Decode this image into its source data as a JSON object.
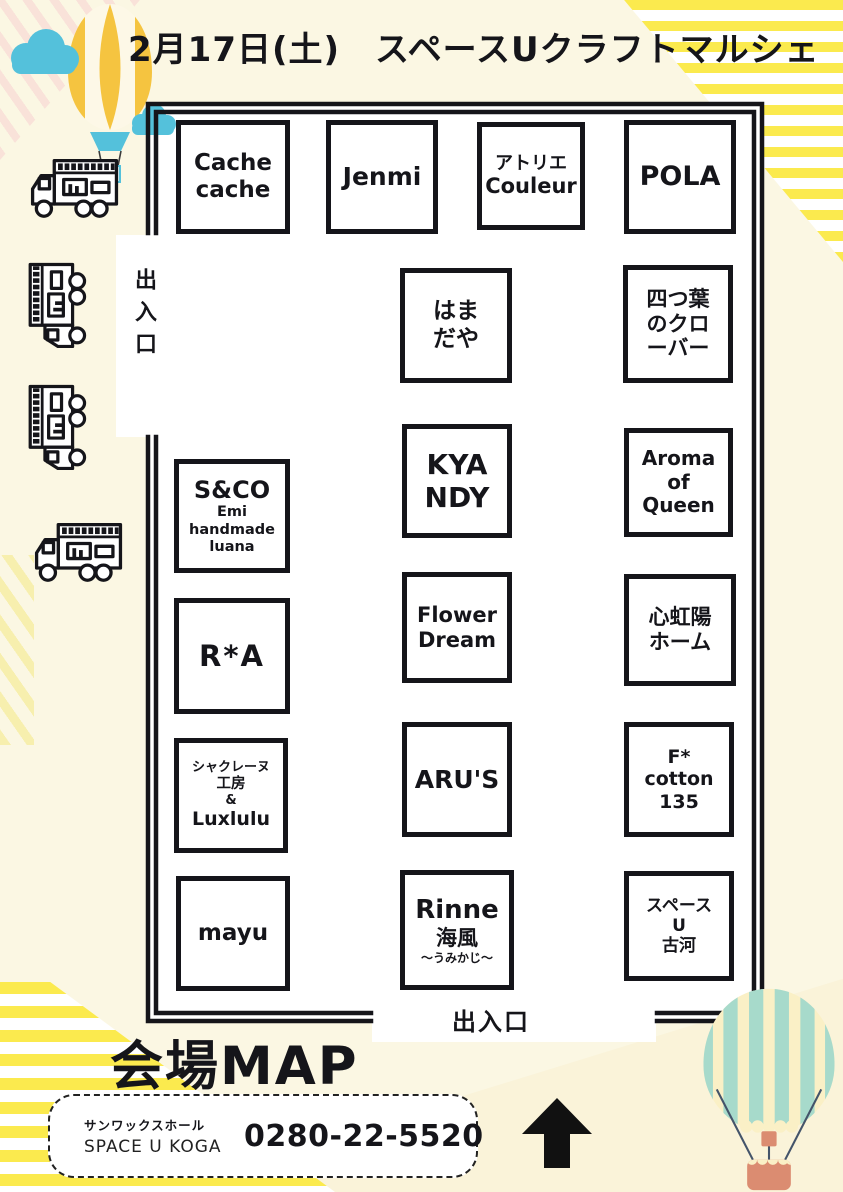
{
  "page": {
    "title": "2月17日(土)　スペースUクラフトマルシェ"
  },
  "map": {
    "entrance_left": "出入口",
    "entrance_bottom": "出入口",
    "booths": [
      {
        "id": "cache-cache",
        "lines": [
          "Cache",
          "cache"
        ]
      },
      {
        "id": "jenmi",
        "lines": [
          "Jenmi"
        ]
      },
      {
        "id": "atelier-couleur",
        "lines": [
          "アトリエ",
          "Couleur"
        ]
      },
      {
        "id": "pola",
        "lines": [
          "POLA"
        ]
      },
      {
        "id": "hamadaya",
        "lines": [
          "はま",
          "だや"
        ]
      },
      {
        "id": "yotsuba-no-clover",
        "lines": [
          "四つ葉",
          "のクロ",
          "ーバー"
        ]
      },
      {
        "id": "s-and-co",
        "lines": [
          "S&CO",
          "Emi",
          "handmade",
          "luana"
        ]
      },
      {
        "id": "kyandy",
        "lines": [
          "KYA",
          "NDY"
        ]
      },
      {
        "id": "aroma-of-queen",
        "lines": [
          "Aroma",
          "of",
          "Queen"
        ]
      },
      {
        "id": "r-a",
        "lines": [
          "R*A"
        ]
      },
      {
        "id": "flower-dream",
        "lines": [
          "Flower",
          "Dream"
        ]
      },
      {
        "id": "shinkouyou-home",
        "lines": [
          "心虹陽",
          "ホーム"
        ]
      },
      {
        "id": "chacrene-koubou-luxlulu",
        "lines": [
          "シャクレーヌ",
          "工房",
          "&",
          "Luxlulu"
        ]
      },
      {
        "id": "arus",
        "lines": [
          "ARU'S"
        ]
      },
      {
        "id": "f-cotton-135",
        "lines": [
          "F*",
          "cotton",
          "135"
        ]
      },
      {
        "id": "mayu",
        "lines": [
          "mayu"
        ]
      },
      {
        "id": "rinne-umikaji",
        "lines": [
          "Rinne",
          "海風",
          "〜うみかじ〜"
        ]
      },
      {
        "id": "space-u-koga",
        "lines": [
          "スペース",
          "U",
          "古河"
        ]
      }
    ]
  },
  "footer": {
    "heading": "会場MAP",
    "venue_hall": "サンワックスホール",
    "venue_name": "SPACE U KOGA",
    "phone": "0280-22-5520"
  },
  "decorations": {
    "top_left_icons": [
      "hot-air-balloon-icon",
      "cloud-icon"
    ],
    "left_column_icons": [
      "food-truck-icon",
      "kitchen-car-icon",
      "kitchen-car-icon",
      "food-truck-icon"
    ],
    "bottom_right_icon": "hot-air-balloon-icon",
    "bottom_arrow_icon": "up-arrow-icon",
    "logo_icon": "cube-box-icon",
    "colors": {
      "ink": "#15151a",
      "cream_bg": "#FBF7E3",
      "stripe_yellow": "#FBEA4E",
      "balloon_yellow": "#F5C440",
      "sky_blue": "#54C1DB",
      "balloon_teal": "#A7DACB",
      "balloon_cream": "#FAF0C6",
      "basket_salmon": "#DB8C71"
    }
  }
}
